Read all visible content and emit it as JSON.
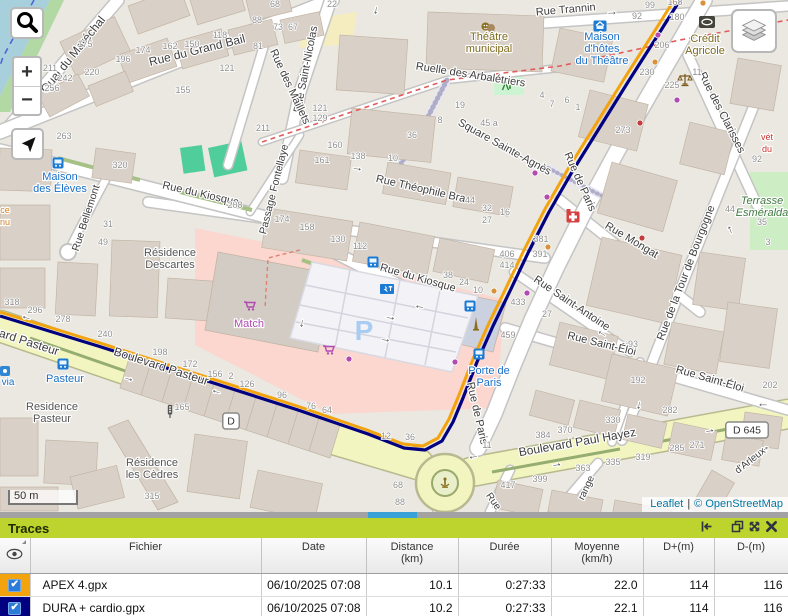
{
  "map": {
    "attribution": {
      "leaflet": "Leaflet",
      "separator": "|",
      "osm": "© OpenStreetMap"
    },
    "scale_bar": "50 m",
    "controls": {
      "zoom_in": "+",
      "zoom_out": "−"
    },
    "track_colors": {
      "apex": "#f2a30e",
      "dura": "#000080"
    },
    "parking_letter": {
      "t": "P",
      "x": 364,
      "y": 340
    },
    "streets": [
      [
        "Quai du Maréchal",
        76,
        57,
        -51,
        12
      ],
      [
        "Rue du Grand Bail",
        198,
        54,
        -14,
        12
      ],
      [
        "Rue Saint-Nicolas",
        309,
        70,
        -79,
        11
      ],
      [
        "Rue des Maillets",
        287,
        88,
        65,
        11
      ],
      [
        "Rue Trannin",
        566,
        13,
        -5,
        11
      ],
      [
        "Ruelle des Arbalétriers",
        470,
        78,
        9,
        11
      ],
      [
        "Square Sainte-Agnès",
        503,
        150,
        29,
        11
      ],
      [
        "Rue Théophile Bra",
        420,
        192,
        13,
        11
      ],
      [
        "Passage Fontellaye",
        277,
        190,
        -76,
        10.5
      ],
      [
        "Rue Bellemont",
        89,
        219,
        -72,
        10.5
      ],
      [
        "Rue du Kiosque",
        200,
        197,
        13,
        11
      ],
      [
        "Rue du Kiosque",
        417,
        281,
        16,
        11
      ],
      [
        "Rue des Clarisses",
        719,
        114,
        63,
        11
      ],
      [
        "Rue de Paris",
        577,
        183,
        66,
        11
      ],
      [
        "Rue de Paris",
        474,
        414,
        77,
        11
      ],
      [
        "Rue Mongat",
        630,
        243,
        31,
        11
      ],
      [
        "Rue de la Tour de Bourgogne",
        689,
        274,
        -69,
        11
      ],
      [
        "Rue Saint-Antoine",
        570,
        306,
        34,
        11
      ],
      [
        "Rue Saint-Éloi",
        601,
        347,
        14,
        11
      ],
      [
        "Rue Saint-Éloi",
        709,
        382,
        16,
        11
      ],
      [
        "vard Pasteur",
        25,
        345,
        18,
        12
      ],
      [
        "Boulevard Pasteur",
        160,
        370,
        18,
        12
      ],
      [
        "Boulevard Paul Hayez",
        578,
        446,
        -10,
        12
      ],
      [
        "range",
        589,
        489,
        -65,
        10
      ],
      [
        "Rue",
        491,
        503,
        55,
        10
      ],
      [
        "d'Arleux",
        752,
        463,
        -38,
        10
      ]
    ],
    "places": [
      {
        "t": "Théâtre|municipal",
        "x": 489,
        "y": 40,
        "c": "#7c6a1e"
      },
      {
        "t": "Maison|d'hôtes|du Théâtre",
        "x": 602,
        "y": 40,
        "c": "#1a6fc7"
      },
      {
        "t": "Crédit|Agricole",
        "x": 705,
        "y": 42,
        "c": "#7c6a1e"
      },
      {
        "t": "Maison|des Élèves",
        "x": 60,
        "y": 180,
        "c": "#1a6fc7"
      },
      {
        "t": "Résidence|Descartes",
        "x": 170,
        "y": 256,
        "c": "#555555"
      },
      {
        "t": "Match",
        "x": 249,
        "y": 327,
        "c": "#b04ab0"
      },
      {
        "t": "Porte de|Paris",
        "x": 489,
        "y": 374,
        "c": "#1a6fc7"
      },
      {
        "t": "Pasteur",
        "x": 65,
        "y": 382,
        "c": "#1a6fc7"
      },
      {
        "t": "Residence|Pasteur",
        "x": 52,
        "y": 410,
        "c": "#555555"
      },
      {
        "t": "Résidence|les Cèdres",
        "x": 152,
        "y": 466,
        "c": "#555555"
      },
      {
        "t": "Terrasse|Esméralda",
        "x": 762,
        "y": 204,
        "c": "#3f7a3f",
        "i": true
      },
      {
        "t": "vét|du",
        "x": 767,
        "y": 140,
        "c": "#cc3333",
        "s": 9
      },
      {
        "t": "ce|nu",
        "x": 5,
        "y": 213,
        "c": "#d07f26",
        "s": 9
      },
      {
        "t": "via",
        "x": 8,
        "y": 385,
        "c": "#1a6fc7",
        "s": 10
      }
    ],
    "house_numbers": [
      [
        "175",
        85,
        47
      ],
      [
        "211",
        50,
        71
      ],
      [
        "242",
        65,
        81
      ],
      [
        "220",
        92,
        75
      ],
      [
        "256",
        52,
        91
      ],
      [
        "263",
        64,
        139
      ],
      [
        "174",
        143,
        53
      ],
      [
        "162",
        170,
        49
      ],
      [
        "150",
        192,
        47
      ],
      [
        "196",
        123,
        62
      ],
      [
        "118",
        220,
        38
      ],
      [
        "88",
        257,
        23
      ],
      [
        "68",
        275,
        7
      ],
      [
        "22",
        332,
        7
      ],
      [
        "73",
        278,
        30
      ],
      [
        "67",
        293,
        30
      ],
      [
        "81",
        258,
        49
      ],
      [
        "121",
        227,
        71
      ],
      [
        "155",
        183,
        93
      ],
      [
        "121",
        320,
        111
      ],
      [
        "129",
        320,
        121
      ],
      [
        "211",
        263,
        131
      ],
      [
        "160",
        335,
        148
      ],
      [
        "161",
        322,
        163
      ],
      [
        "138",
        358,
        159
      ],
      [
        "10",
        393,
        161
      ],
      [
        "36",
        412,
        138
      ],
      [
        "8",
        440,
        123
      ],
      [
        "19",
        460,
        108
      ],
      [
        "45 a",
        489,
        126
      ],
      [
        "4",
        542,
        98
      ],
      [
        "7",
        552,
        107
      ],
      [
        "6",
        567,
        103
      ],
      [
        "1",
        578,
        110
      ],
      [
        "320",
        120,
        168
      ],
      [
        "208",
        235,
        208
      ],
      [
        "31",
        108,
        227
      ],
      [
        "49",
        103,
        245
      ],
      [
        "174",
        282,
        222
      ],
      [
        "158",
        307,
        230
      ],
      [
        "130",
        338,
        242
      ],
      [
        "112",
        360,
        249
      ],
      [
        "44",
        470,
        203
      ],
      [
        "32",
        487,
        211
      ],
      [
        "16",
        505,
        215
      ],
      [
        "27",
        487,
        223
      ],
      [
        "406",
        507,
        257
      ],
      [
        "414",
        507,
        268
      ],
      [
        "38",
        448,
        278
      ],
      [
        "24",
        464,
        285
      ],
      [
        "10",
        478,
        293
      ],
      [
        "99",
        650,
        8
      ],
      [
        "168",
        675,
        5
      ],
      [
        "92",
        637,
        19
      ],
      [
        "180",
        677,
        20
      ],
      [
        "206",
        662,
        48
      ],
      [
        "230",
        647,
        75
      ],
      [
        "225",
        672,
        88
      ],
      [
        "11",
        697,
        75
      ],
      [
        "273",
        623,
        133
      ],
      [
        "92",
        757,
        162
      ],
      [
        "44",
        730,
        212
      ],
      [
        "35",
        762,
        225
      ],
      [
        "3",
        768,
        245
      ],
      [
        "381",
        541,
        242
      ],
      [
        "391",
        540,
        257
      ],
      [
        "433",
        518,
        305
      ],
      [
        "27",
        547,
        317
      ],
      [
        "459",
        508,
        338
      ],
      [
        "93",
        633,
        347
      ],
      [
        "192",
        638,
        383
      ],
      [
        "202",
        770,
        388
      ],
      [
        "156",
        215,
        377
      ],
      [
        "2",
        231,
        379
      ],
      [
        "126",
        247,
        387
      ],
      [
        "96",
        282,
        398
      ],
      [
        "76",
        311,
        409
      ],
      [
        "64",
        327,
        413
      ],
      [
        "318",
        12,
        305
      ],
      [
        "296",
        35,
        313
      ],
      [
        "278",
        63,
        322
      ],
      [
        "240",
        105,
        337
      ],
      [
        "198",
        160,
        355
      ],
      [
        "172",
        190,
        367
      ],
      [
        "165",
        182,
        410
      ],
      [
        "315",
        152,
        499
      ],
      [
        "12",
        386,
        439
      ],
      [
        "36",
        410,
        440
      ],
      [
        "11",
        487,
        448
      ],
      [
        "384",
        543,
        438
      ],
      [
        "370",
        565,
        433
      ],
      [
        "330",
        613,
        423
      ],
      [
        "282",
        670,
        413
      ],
      [
        "363",
        583,
        471
      ],
      [
        "335",
        613,
        465
      ],
      [
        "319",
        643,
        460
      ],
      [
        "285",
        677,
        451
      ],
      [
        "271",
        697,
        448
      ],
      [
        "417",
        508,
        488
      ],
      [
        "399",
        540,
        482
      ],
      [
        "68",
        398,
        488
      ],
      [
        "88",
        400,
        505
      ]
    ],
    "shields": [
      [
        "D",
        231,
        421
      ],
      [
        "D 645",
        747,
        430
      ]
    ],
    "arrows": [
      [
        612,
        15,
        -3
      ],
      [
        374,
        10,
        100
      ],
      [
        357,
        171,
        8
      ],
      [
        27,
        316,
        197
      ],
      [
        128,
        381,
        17
      ],
      [
        217,
        390,
        197
      ],
      [
        473,
        455,
        170
      ],
      [
        557,
        467,
        -10
      ],
      [
        710,
        433,
        -10
      ],
      [
        637,
        405,
        100
      ],
      [
        603,
        332,
        213
      ],
      [
        763,
        403,
        180
      ],
      [
        732,
        229,
        -112
      ],
      [
        766,
        451,
        -38
      ],
      [
        300,
        323,
        100
      ],
      [
        390,
        320,
        10
      ],
      [
        385,
        342,
        10
      ],
      [
        420,
        305,
        190
      ]
    ],
    "dots": {
      "purple": [
        [
          658,
          35
        ],
        [
          677,
          100
        ],
        [
          535,
          173
        ],
        [
          547,
          197
        ],
        [
          349,
          359
        ],
        [
          455,
          362
        ],
        [
          527,
          293
        ]
      ],
      "red": [
        [
          642,
          238
        ],
        [
          640,
          123
        ]
      ],
      "orange": [
        [
          703,
          3
        ],
        [
          655,
          62
        ],
        [
          494,
          291
        ],
        [
          548,
          247
        ]
      ]
    },
    "icons": [
      [
        "bus",
        58,
        163
      ],
      [
        "bus",
        63,
        364
      ],
      [
        "bus",
        373,
        262
      ],
      [
        "bus",
        470,
        306
      ],
      [
        "bus",
        479,
        354
      ],
      [
        "cart",
        250,
        306
      ],
      [
        "cart",
        329,
        350
      ],
      [
        "ev",
        387,
        289
      ],
      [
        "pharm",
        573,
        217
      ],
      [
        "scales",
        685,
        80
      ],
      [
        "masks",
        488,
        27
      ],
      [
        "bank",
        707,
        22
      ],
      [
        "guest",
        600,
        26
      ],
      [
        "playfig",
        507,
        86
      ],
      [
        "monument",
        476,
        325
      ],
      [
        "tlight",
        170,
        412
      ],
      [
        "fountain",
        445,
        483
      ],
      [
        "poi",
        5,
        371
      ]
    ]
  },
  "panel": {
    "title": "Traces",
    "toolbar": [
      "collapse-left",
      "detach",
      "maximize",
      "close"
    ],
    "table": {
      "columns": [
        {
          "key": "visibility",
          "label": "",
          "width": 30,
          "align": "center"
        },
        {
          "key": "file",
          "label": "Fichier",
          "width": 231,
          "align": "left"
        },
        {
          "key": "date",
          "label": "Date",
          "width": 105,
          "align": "right"
        },
        {
          "key": "distance",
          "label": "Distance",
          "unit": "(km)",
          "width": 92,
          "align": "right"
        },
        {
          "key": "duration",
          "label": "Durée",
          "width": 93,
          "align": "right"
        },
        {
          "key": "average",
          "label": "Moyenne",
          "unit": "(km/h)",
          "width": 92,
          "align": "right"
        },
        {
          "key": "dplus",
          "label": "D+(m)",
          "width": 71,
          "align": "right"
        },
        {
          "key": "dminus",
          "label": "D-(m)",
          "width": 74,
          "align": "right"
        }
      ],
      "rows": [
        {
          "file": "APEX 4.gpx",
          "date": "06/10/2025 07:08",
          "distance": "10.1",
          "duration": "0:27:33",
          "average": "22.0",
          "dplus": "114",
          "dminus": "116",
          "color": "#f2a30e",
          "checked": true
        },
        {
          "file": "DURA + cardio.gpx",
          "date": "06/10/2025 07:08",
          "distance": "10.2",
          "duration": "0:27:33",
          "average": "22.1",
          "dplus": "114",
          "dminus": "116",
          "color": "#000080",
          "checked": true
        }
      ]
    }
  }
}
